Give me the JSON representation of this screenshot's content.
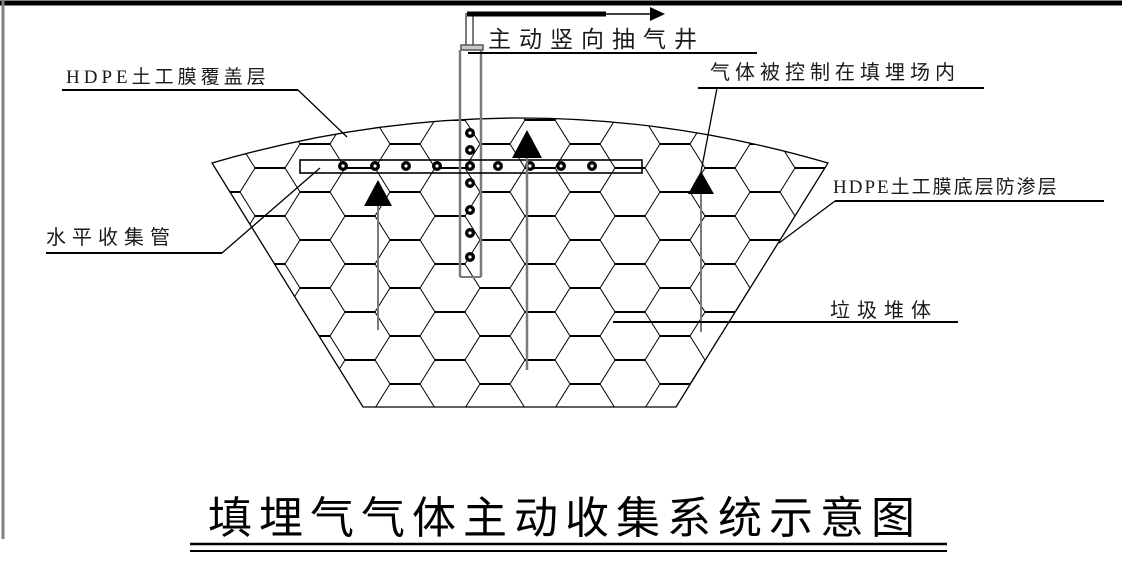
{
  "diagram": {
    "title": "填埋气气体主动收集系统示意图",
    "labels": {
      "vertical_well": "主动竖向抽气井",
      "hdpe_cover": "HDPE土工膜覆盖层",
      "gas_contained": "气体被控制在填埋场内",
      "horizontal_pipe": "水平收集管",
      "hdpe_bottom_liner": "HDPE土工膜底层防渗层",
      "waste_body": "垃圾堆体"
    },
    "colors": {
      "line": "#000000",
      "pipe_gray": "#808080",
      "background": "#ffffff"
    }
  }
}
